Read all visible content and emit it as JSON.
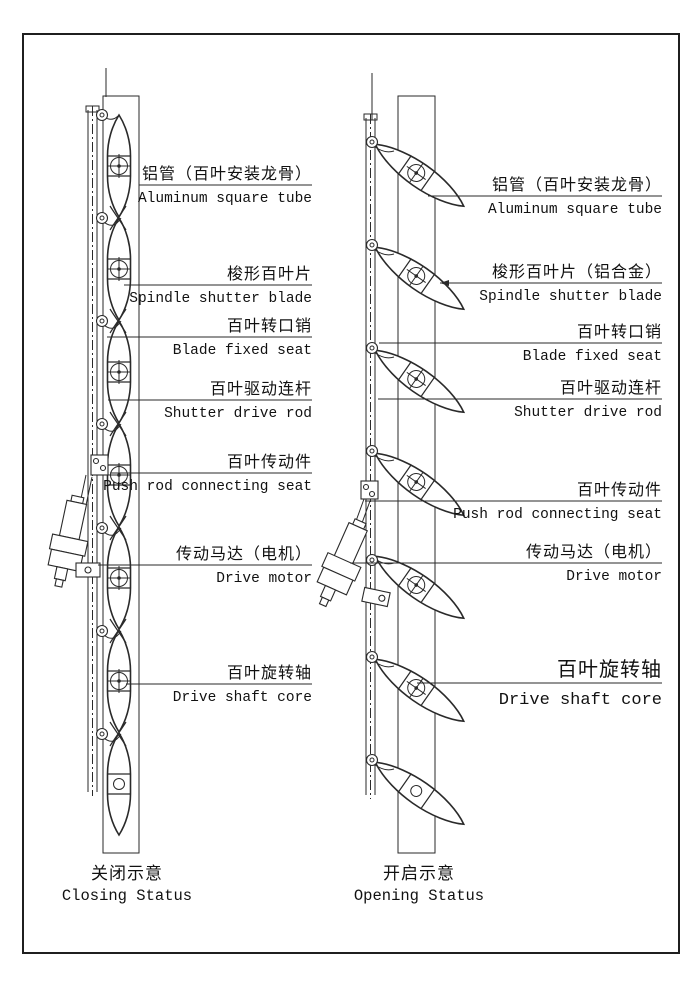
{
  "colors": {
    "line": "#2a2a2a",
    "text": "#111111",
    "background": "#ffffff"
  },
  "captions": {
    "left_zh": "关闭示意",
    "left_en": "Closing Status",
    "right_zh": "开启示意",
    "right_en": "Opening Status"
  },
  "left_labels": [
    {
      "zh": "铝管（百叶安装龙骨）",
      "en": "Aluminum square tube"
    },
    {
      "zh": "梭形百叶片",
      "en": "Spindle shutter blade"
    },
    {
      "zh": "百叶转口销",
      "en": "Blade fixed seat"
    },
    {
      "zh": "百叶驱动连杆",
      "en": "Shutter drive rod"
    },
    {
      "zh": "百叶传动件",
      "en": "Push rod connecting seat"
    },
    {
      "zh": "传动马达（电机）",
      "en": "Drive motor"
    },
    {
      "zh": "百叶旋转轴",
      "en": "Drive shaft core"
    }
  ],
  "right_labels": [
    {
      "zh": "铝管（百叶安装龙骨）",
      "en": "Aluminum square tube"
    },
    {
      "zh": "梭形百叶片（铝合金）",
      "en": "Spindle shutter blade"
    },
    {
      "zh": "百叶转口销",
      "en": "Blade fixed seat"
    },
    {
      "zh": "百叶驱动连杆",
      "en": "Shutter drive rod"
    },
    {
      "zh": "百叶传动件",
      "en": "Push rod connecting seat"
    },
    {
      "zh": "传动马达（电机）",
      "en": "Drive motor"
    },
    {
      "zh": "百叶旋转轴",
      "en": "Drive shaft core"
    }
  ]
}
